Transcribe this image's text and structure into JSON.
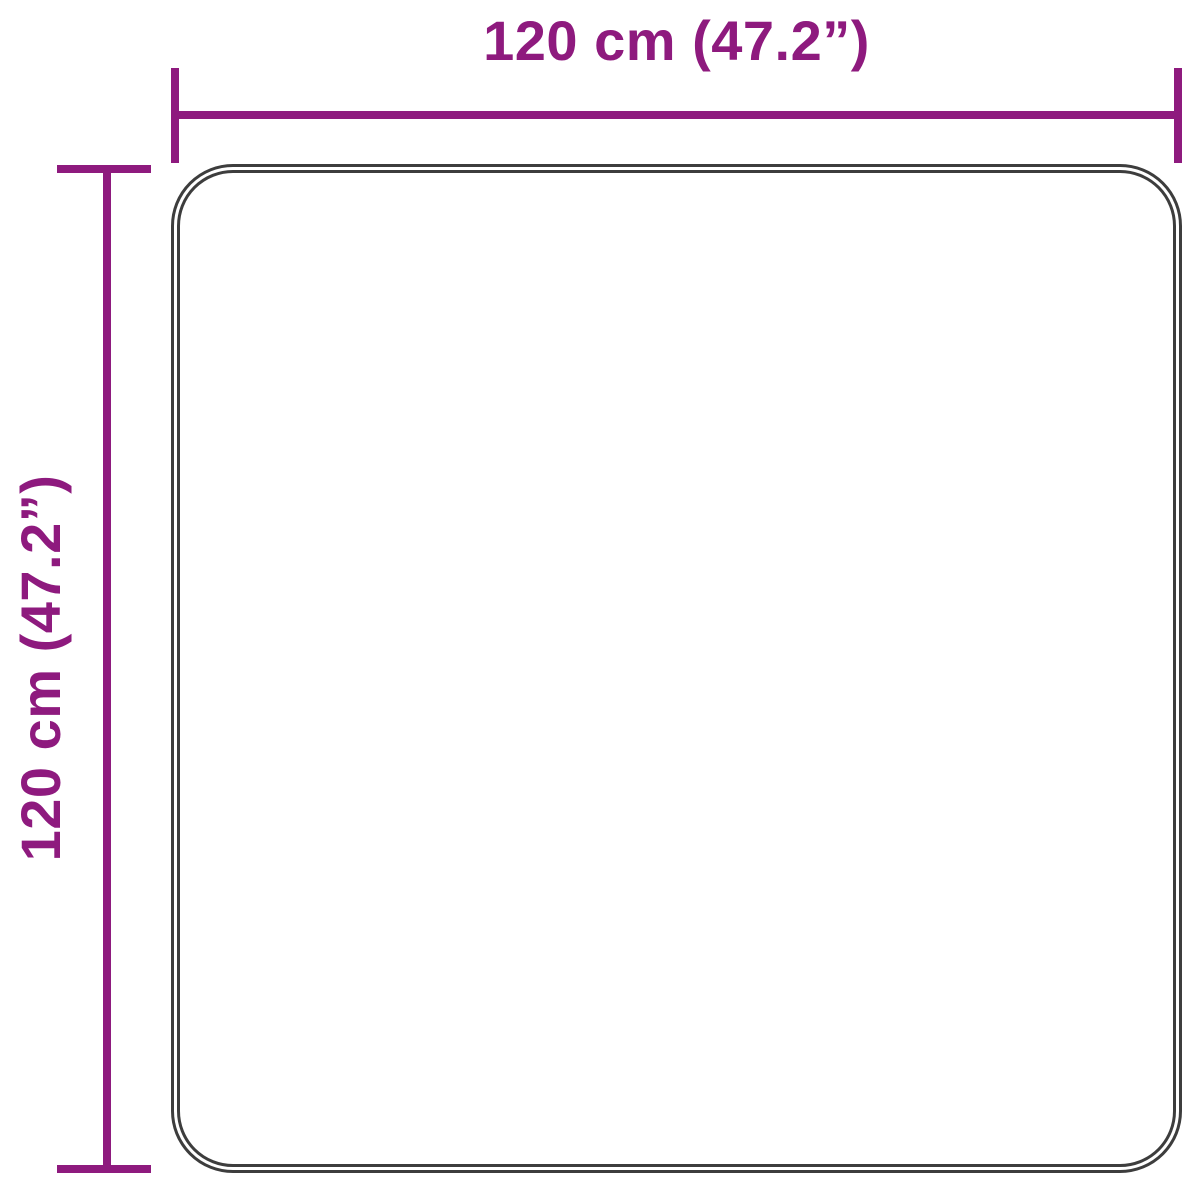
{
  "diagram": {
    "type": "product-dimension-diagram",
    "subject": "rug-top-view",
    "width_dimension": {
      "label": "120 cm (47.2”)"
    },
    "height_dimension": {
      "label": "120 cm (47.2”)"
    }
  },
  "colors": {
    "accent": "#8e1a7e",
    "outline": "#3d3d3d",
    "background": "#ffffff"
  }
}
